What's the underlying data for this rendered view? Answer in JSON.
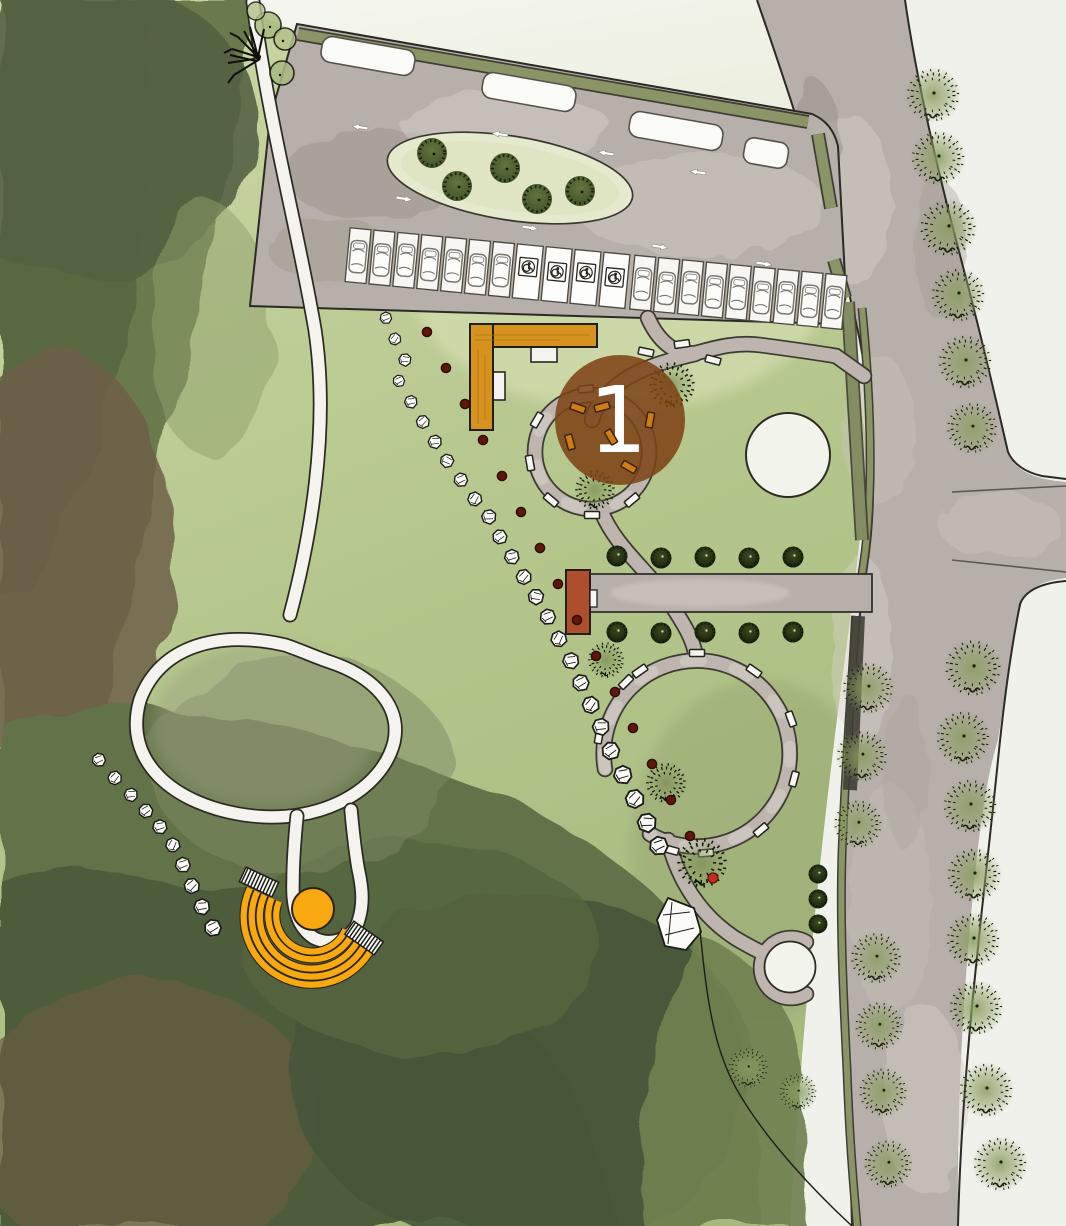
{
  "marker": {
    "label": "1"
  },
  "palette": {
    "lawn": "#b7c78e",
    "lawn_light": "#d8e0b6",
    "pale": "#edefe0",
    "offwhite": "#f0f1ea",
    "asphalt": "#b7afa9",
    "asphalt_light": "#d6d0c9",
    "gravel": "#bdb5ae",
    "path_white": "#f4f3ee",
    "ink": "#2b2a24",
    "olive": "#8b9466",
    "forest": "#68774b",
    "forest_dark": "#4d5c38",
    "forest_brown": "#6e5f49",
    "orange": "#d6921e",
    "amber": "#f7a90f",
    "terracotta": "#ad4f2d",
    "marker_brown": "#7d4316",
    "marker_text": "#ffffff",
    "dot_red": "#5f170b",
    "dot_red_bright": "#c0301a",
    "tree_dark": "#29320f",
    "tree_glow": "#879a5c",
    "stone_white": "#fbfbf8"
  },
  "parking": {
    "car_stall_count": 16,
    "accessible_stall_count": 4,
    "bus_bay_count": 4
  },
  "icons": {
    "accessible": "accessible-parking-icon",
    "car": "car-icon",
    "arrow": "traffic-arrow-icon",
    "tree": "tree-icon",
    "rock": "boulder-icon",
    "bench": "bench-icon"
  }
}
